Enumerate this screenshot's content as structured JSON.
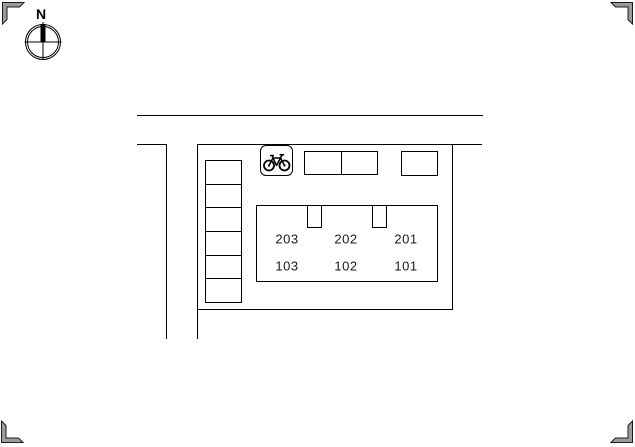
{
  "compass": {
    "north_label": "N"
  },
  "plan": {
    "building": {
      "units_upper": [
        "203",
        "202",
        "201"
      ],
      "units_lower": [
        "103",
        "102",
        "101"
      ]
    },
    "bicycle_parking": {
      "icon": "bicycle-icon"
    }
  },
  "colors": {
    "line": "#000000",
    "background": "#ffffff",
    "corner_mark_fill": "#9c9c9c"
  }
}
